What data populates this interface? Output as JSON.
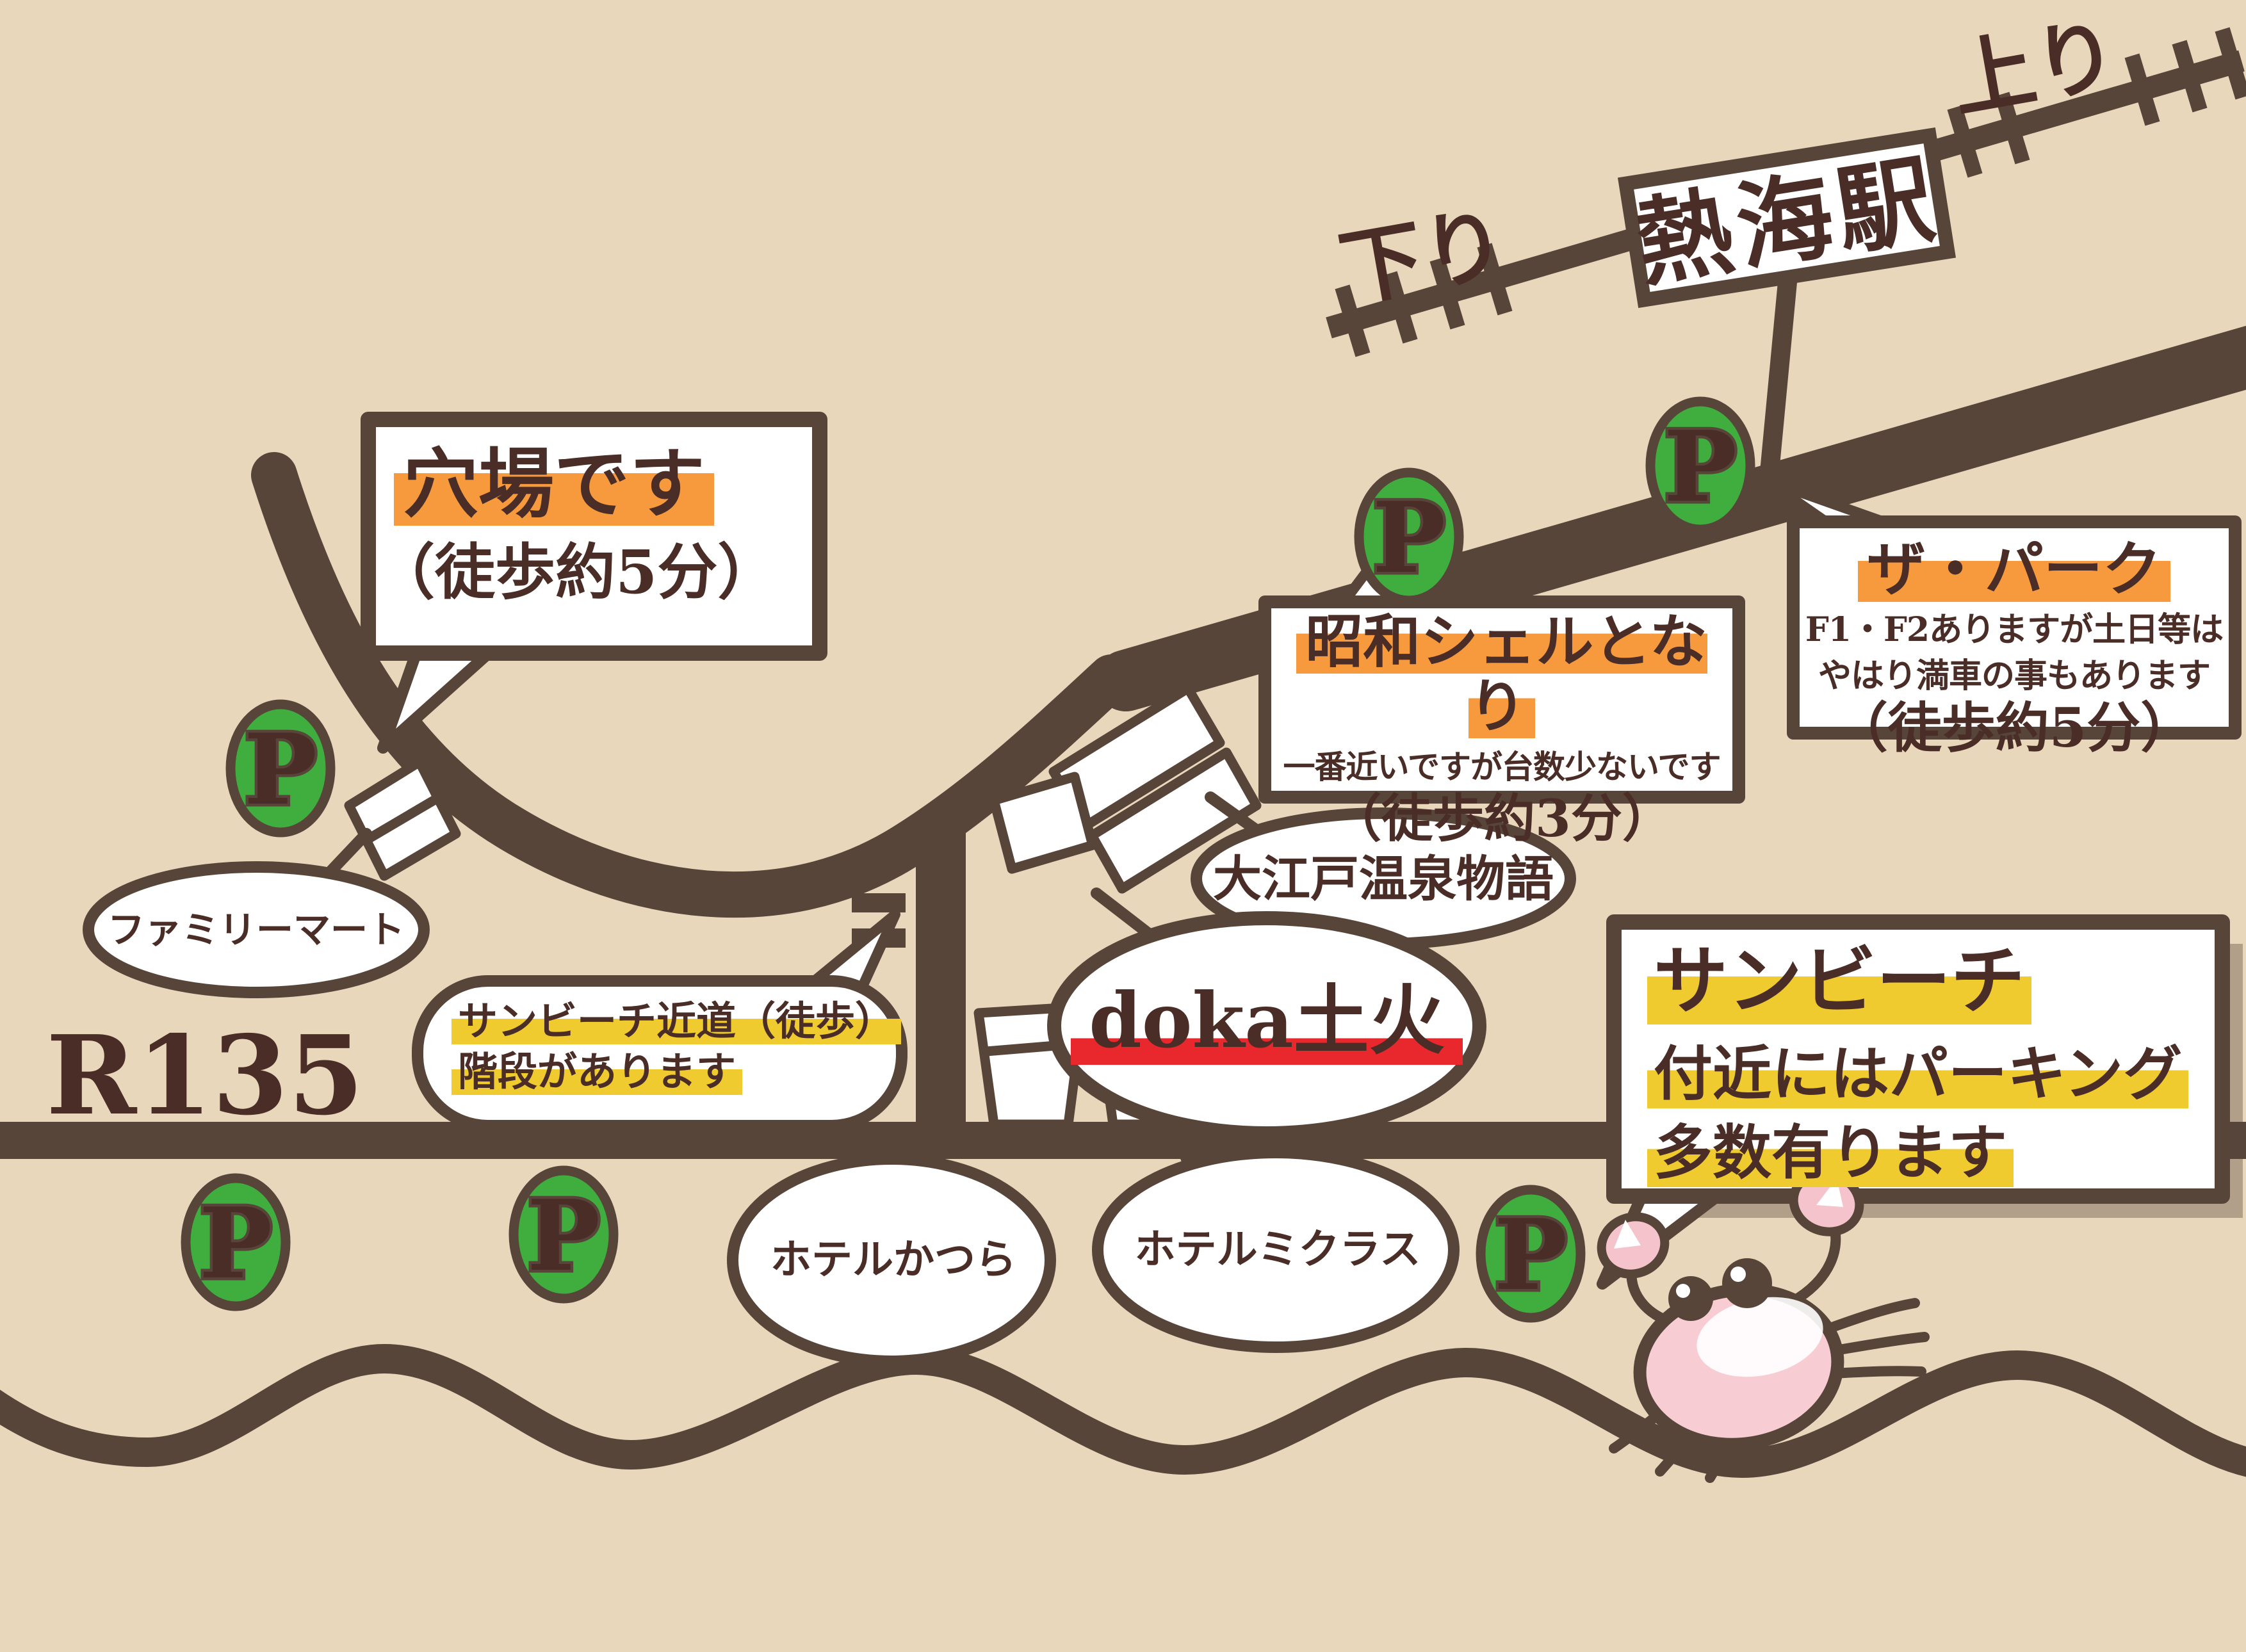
{
  "station": {
    "name": "熱海駅",
    "label_down": "下り",
    "label_up": "上り"
  },
  "road": {
    "route_label": "R135"
  },
  "parking": {
    "letter": "P"
  },
  "bubbles": {
    "anaba": {
      "line1": "穴場です",
      "line2": "（徒歩約5分）"
    },
    "the_park": {
      "title": "ザ・パーク",
      "line1": "F1・F2ありますが土日等は",
      "line2": "やはり満車の事もあります",
      "line3": "（徒歩約5分）"
    },
    "showa_shell": {
      "title": "昭和シェルとなり",
      "line1": "一番近いですが台数少ないです",
      "line2": "（徒歩約3分）"
    },
    "ooedo_onsen": {
      "label": "大江戸温泉物語"
    },
    "doka": {
      "label": "doka土火"
    },
    "familymart": {
      "label": "ファミリーマート"
    },
    "sunbeach_shortcut": {
      "line1": "サンビーチ近道（徒歩）",
      "line2": "階段があります"
    },
    "sunbeach": {
      "line1": "サンビーチ",
      "line2": "付近にはパーキング",
      "line3": "多数有ります"
    },
    "hotel_katsura": {
      "label": "ホテルかつら"
    },
    "hotel_micuras": {
      "label": "ホテルミクラス"
    }
  },
  "colors": {
    "background": "#e9d7bc",
    "line_brown": "#57453a",
    "text_brown": "#4a2d26",
    "highlight_orange": "#f79a3e",
    "highlight_yellow": "#f0cb2f",
    "underline_red": "#e8282d",
    "parking_green": "#3fae3e",
    "parking_letter_yellow": "#f2c12e",
    "crab_pink": "#f7ccd2"
  }
}
